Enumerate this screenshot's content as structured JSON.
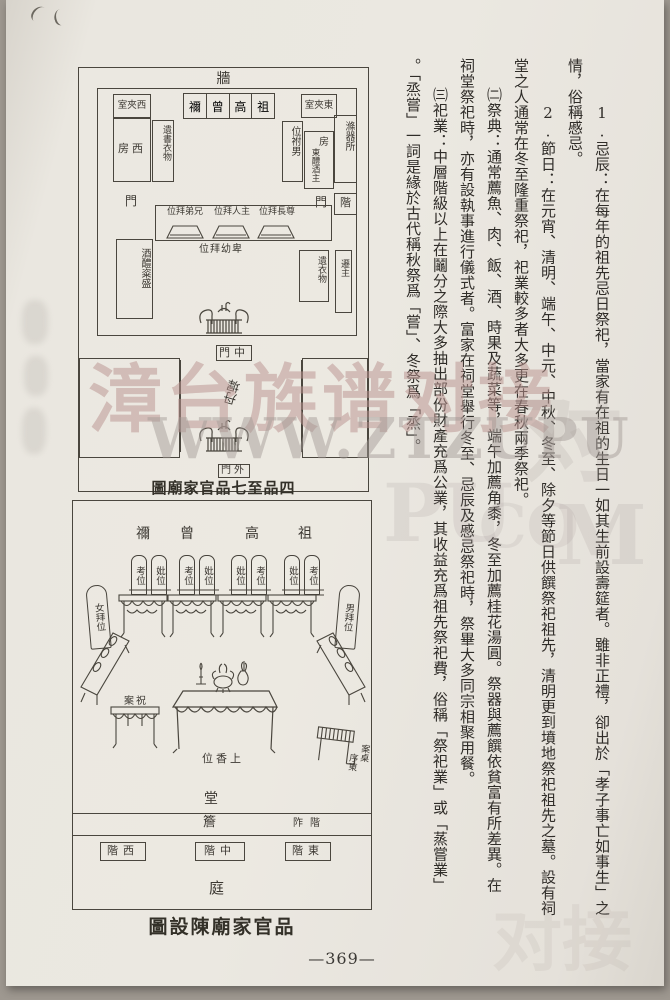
{
  "page": {
    "number": "—369—"
  },
  "watermark": {
    "cn": "漳台族谱对接",
    "url": "WWW.ZTZUPU",
    "frag_dui": "对",
    "frag_pu": "PU",
    "frag_co": ".CO",
    "frag_m": "M",
    "frag_bottom": "对接"
  },
  "diagram1": {
    "caption": "圖廟家官品七至品四",
    "wall": "牆",
    "west_chamber": "室夾西",
    "east_chamber": "室夾東",
    "shrines": [
      "禰",
      "曾",
      "高",
      "祖"
    ],
    "west_room": "房西",
    "west_store": "遺書衣物",
    "east_attach": "位祔男",
    "east_room": "房",
    "east_room_note": "東醴酒主",
    "washing_place": "滌器所",
    "east_step": "階",
    "door_west": "門",
    "door_east": "門",
    "bow_brothers": "位拜弟兄",
    "bow_master": "位拜人主",
    "bow_elders": "位拜長尊",
    "bow_juniors": "位拜幼卑",
    "sw_store": "酒醴粢盛",
    "se_store": "遺衣物",
    "se_store2": "遷主",
    "middle_gate": "門中",
    "courtyard": "丹墀",
    "outer_gate": "門外"
  },
  "diagram2": {
    "caption": "圖設陳廟家官品",
    "heads": [
      "禰",
      "曾",
      "高",
      "祖"
    ],
    "tablets": [
      "考位",
      "妣位",
      "考位",
      "妣位",
      "妣位",
      "考位",
      "妣位",
      "考位"
    ],
    "female_bow": "女拜位",
    "male_bow": "男拜位",
    "prayer_table": "案祝",
    "incense_pos": "位香上",
    "east_table_a": "案桌",
    "east_table_b": "序東",
    "hall": "堂",
    "eaves": "簷",
    "porch_steps": "阼階",
    "west_steps": "階西",
    "center_steps": "階中",
    "east_steps": "階東",
    "court": "庭"
  },
  "text": {
    "cols": [
      "1.忌辰：在每年的祖先忌日祭祀，當家有在祖的生日一如其生前設壽筵者。雖非正禮，卻出於「孝子事亡如事生」之",
      "情，俗稱慼忌。",
      "2.節日：在元宵、清明、端午、中元、中秋、冬至、除夕等節日供饌祭祀祖先，清明更到墳地祭祀祖先之墓。設有祠",
      "堂之人通常在冬至隆重祭祀，祀業較多者大多更在春秋兩季祭祀。",
      "㈡祭典：通常薦魚、肉、飯、酒、時果及蔬菜等，端午加薦角黍，冬至加薦桂花湯圓。祭器與薦饌依貧富有所差異。在",
      "祠堂祭祀時，亦有設執事進行儀式者。富家在祠堂舉行冬至、忌辰及慼忌祭祀時，祭畢大多同宗相聚用餐。",
      "㈢祀業：中層階級以上在鬮分之際大多抽出部份財產充爲公業，其收益充爲祖先祭祀費，俗稱「祭祀業」或「蒸嘗業」",
      "。「烝嘗」一詞是緣於古代稱秋祭爲「嘗」、冬祭爲「烝」。"
    ]
  }
}
